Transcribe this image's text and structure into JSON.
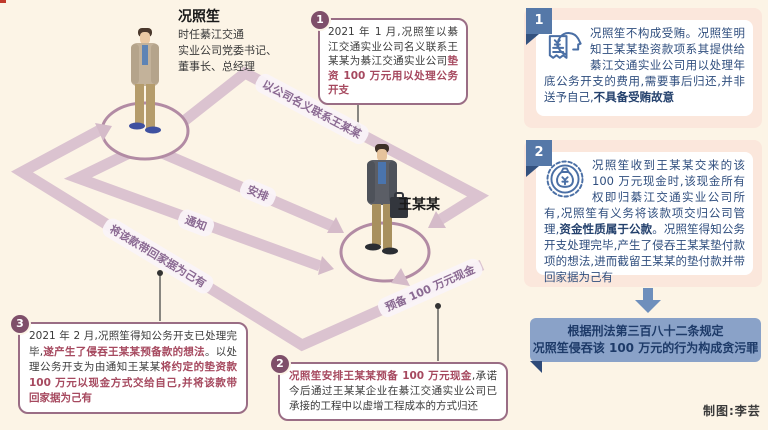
{
  "page": {
    "credit": "制图:李芸"
  },
  "colors": {
    "background": "#fcf4e6",
    "ribbon": "#dbc3d0",
    "callout_accent": "#9a6d85",
    "callout_bold": "#a6495f",
    "panel_bg": "#fbe7dc",
    "panel_tab": "#5578a8",
    "panel_text": "#2f4e7e",
    "conclusion_bg": "#8aa2c8",
    "conclusion_text": "#1d3a68"
  },
  "actors": {
    "kuang": {
      "name": "况照笙",
      "desc_lines": [
        "时任綦江交通",
        "实业公司党委书记、",
        "董事长、总经理"
      ]
    },
    "wang": {
      "name": "王某某"
    }
  },
  "flow_labels": {
    "contact": "以公司名义联系王某某",
    "arrange": "安排",
    "notify": "通知",
    "take_home": "将该款带回家据为己有",
    "prepare": "预备 100 万元现金"
  },
  "callouts": [
    {
      "num": "1",
      "segments": [
        {
          "text": "2021 年 1 月,况照笙以綦江交通实业公司名义联系王某某为綦江交通实业公司",
          "bold": false
        },
        {
          "text": "垫资 100 万元用以处理公务开支",
          "bold": true
        }
      ]
    },
    {
      "num": "2",
      "segments": [
        {
          "text": "况照笙安排王某某预备 100 万元现金",
          "bold": true
        },
        {
          "text": ",承诺今后通过王某某企业在綦江交通实业公司已承接的工程中以虚增工程成本的方式归还",
          "bold": false
        }
      ]
    },
    {
      "num": "3",
      "segments": [
        {
          "text": "2021 年 2 月,况照笙得知公务开支已处理完毕,",
          "bold": false
        },
        {
          "text": "遂产生了侵吞王某某预备款的想法",
          "bold": true
        },
        {
          "text": "。以处理公务开支为由通知王某某",
          "bold": false
        },
        {
          "text": "将约定的垫资款 100 万元以现金方式交给自己,并将该款带回家据为己有",
          "bold": true
        }
      ]
    }
  ],
  "rulings": [
    {
      "num": "1",
      "icon": "receipt-person-icon",
      "segments": [
        {
          "text": "况照笙不构成受贿。况照笙明知王某某垫资款项系其提供给綦江交通实业公司用以处理年底公务开支的费用,需要事后归还,并非送予自己,",
          "bold": false
        },
        {
          "text": "不具备受贿故意",
          "bold": true
        }
      ]
    },
    {
      "num": "2",
      "icon": "money-bag-badge-icon",
      "segments": [
        {
          "text": "况照笙收到王某某交来的该 100 万元现金时,该现金所有权即归綦江交通实业公司所有,况照笙有义务将该款项交归公司管理,",
          "bold": false
        },
        {
          "text": "资金性质属于公款",
          "bold": true
        },
        {
          "text": "。况照笙得知公务开支处理完毕,产生了侵吞王某某垫付款项的想法,进而截留王某某的垫付款并带回家据为己有",
          "bold": false
        }
      ]
    }
  ],
  "conclusion": {
    "line1": "根据刑法第三百八十二条规定",
    "line2": "况照笙侵吞该 100 万元的行为构成贪污罪"
  }
}
